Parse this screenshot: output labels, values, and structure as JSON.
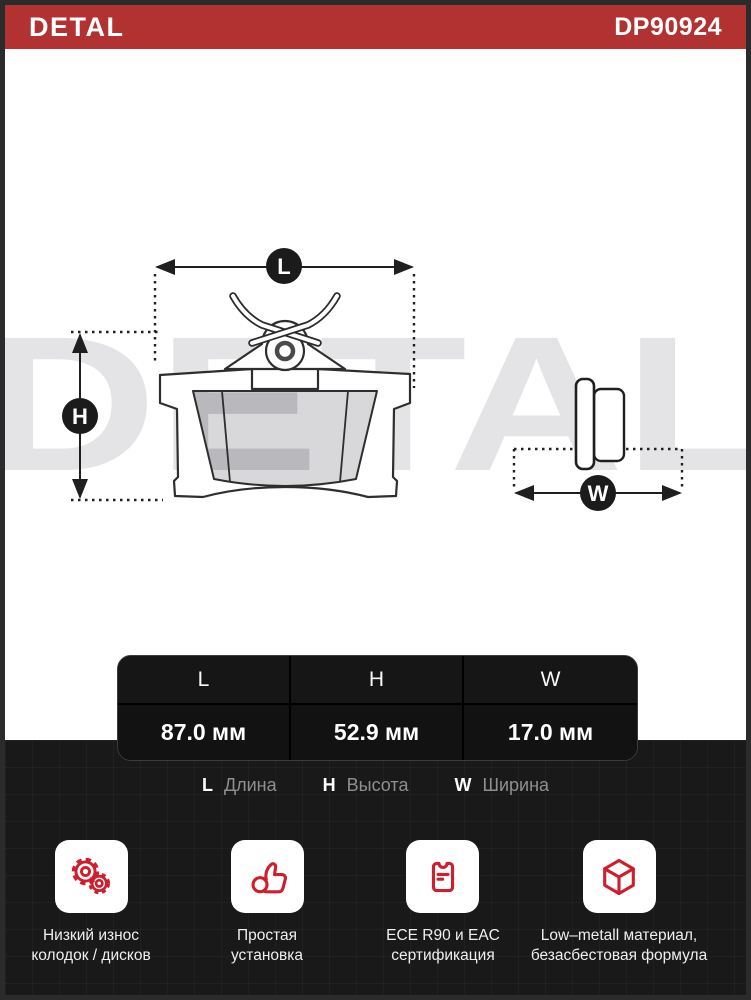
{
  "header": {
    "brand": "DETAL",
    "part_number": "DP90924"
  },
  "watermark": "DETAL",
  "diagram": {
    "length_label": "L",
    "height_label": "H",
    "width_label": "W"
  },
  "table": {
    "headers": [
      "L",
      "H",
      "W"
    ],
    "values": [
      "87.0 мм",
      "52.9 мм",
      "17.0 мм"
    ]
  },
  "legend": {
    "items": [
      {
        "letter": "L",
        "label": "Длина"
      },
      {
        "letter": "H",
        "label": "Высота"
      },
      {
        "letter": "W",
        "label": "Ширина"
      }
    ]
  },
  "features": {
    "items": [
      {
        "icon": "gears-icon",
        "line1": "Низкий износ",
        "line2": "колодок / дисков"
      },
      {
        "icon": "thumb-up-icon",
        "line1": "Простая",
        "line2": "установка"
      },
      {
        "icon": "certificate-icon",
        "line1": "ECE R90 и EAC",
        "line2": "сертификация"
      },
      {
        "icon": "cube-icon",
        "line1": "Low–metall материал,",
        "line2": "безасбестовая формула"
      }
    ]
  },
  "colors": {
    "accent_red": "#b23232",
    "icon_red": "#ce1f2e",
    "dark_bg": "#191919",
    "line": "#1f1f1f"
  }
}
